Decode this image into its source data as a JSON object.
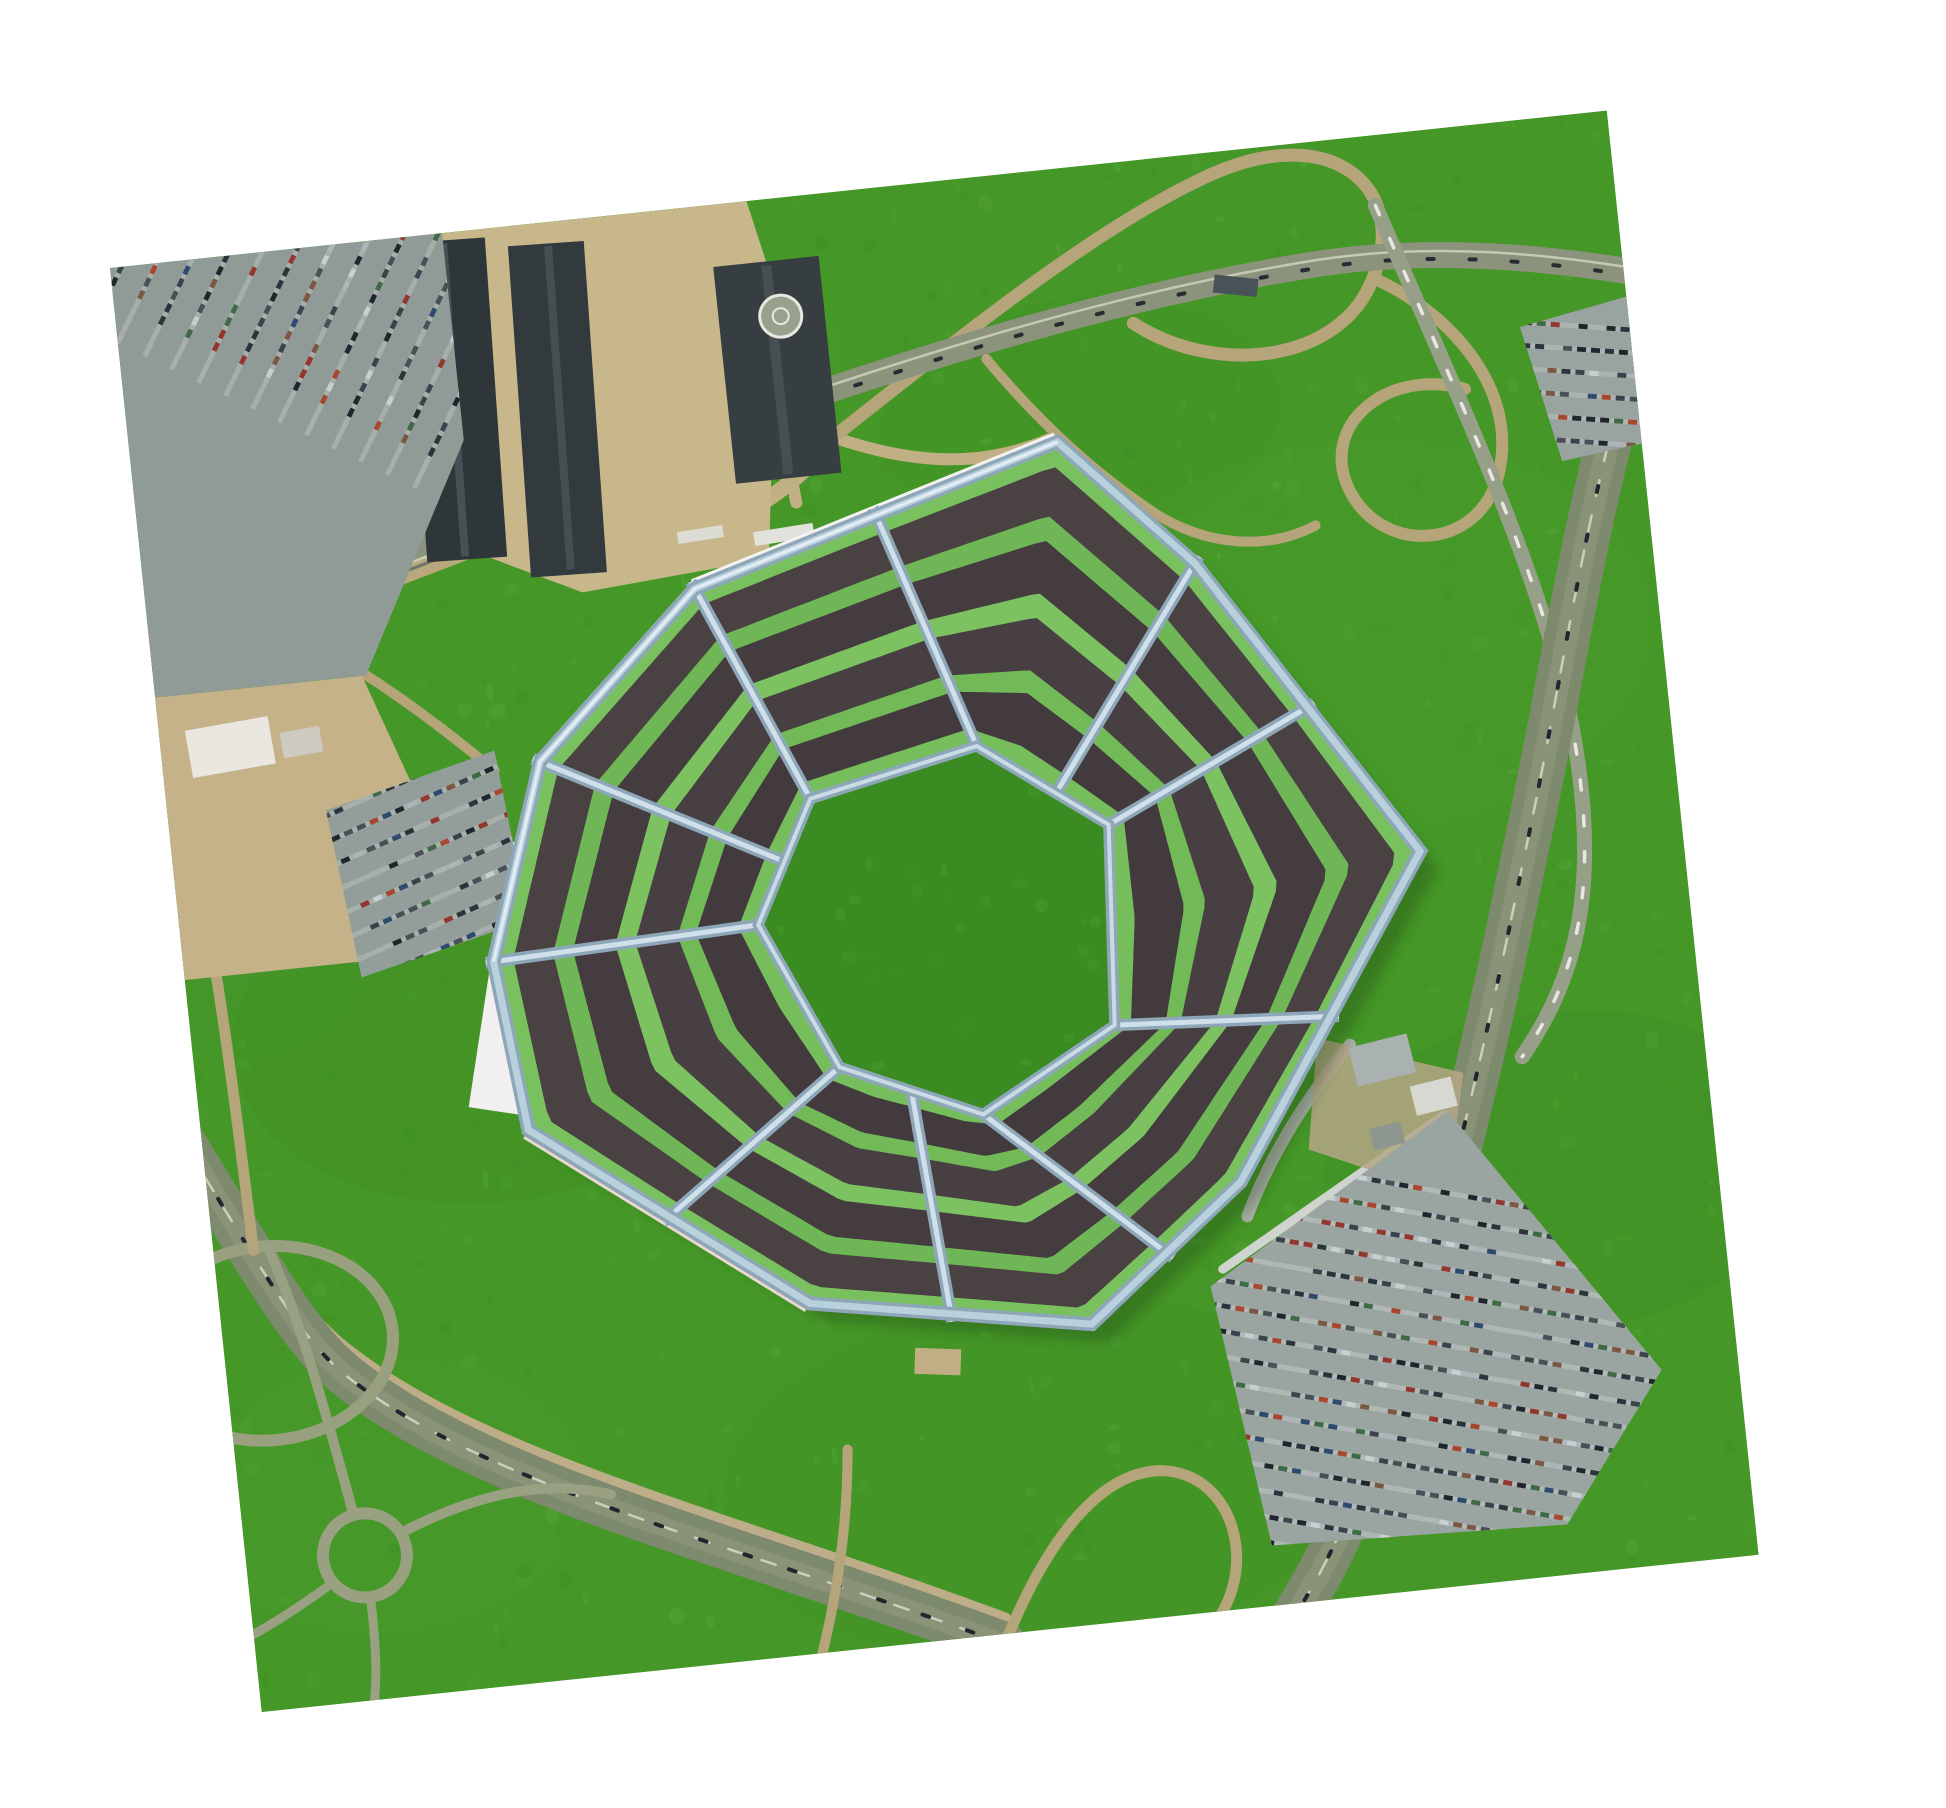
{
  "scene": {
    "description": "aerial-photo-of-heptagon-pentagon-building",
    "canvas": {
      "w": 1946,
      "h": 1808,
      "bg": "#ffffff"
    }
  },
  "photo": {
    "x": 110,
    "y": 268,
    "w": 1505,
    "h": 1452,
    "rotation_deg": -6,
    "base": "#459727"
  },
  "colors": {
    "grass_dark": "#3c8a20",
    "grass_light": "#55ab36",
    "grass_mid": "#498f2b",
    "grass_bright": "#63b545",
    "courtyard": "#3a8c22",
    "stripe_darks": [
      "#4a4143",
      "#443c3f",
      "#473f41",
      "#423a3d"
    ],
    "stripe_greens": [
      "#79c05f",
      "#6fb756",
      "#7cc261",
      "#72b958",
      "#76bd5c"
    ],
    "wall_main": "#8da7b8",
    "wall_light": "#b9d0dd",
    "wall_bright": "#e3eef4",
    "maroon_base": "#6e4038",
    "white_fringe": "#f4f1ef",
    "road_tan": "#b6a47a",
    "road_gray": "#8c937c",
    "highway": "#7d8a6d",
    "parking_gray": "#97a29e"
  },
  "grass": {
    "speckle_count": 650,
    "patches": [
      {
        "cx": 300,
        "cy": 800,
        "rx": 260,
        "ry": 170,
        "fill": "#3c8a20",
        "op": 0.18
      },
      {
        "cx": 1200,
        "cy": 500,
        "rx": 300,
        "ry": 200,
        "fill": "#52a833",
        "op": 0.15
      },
      {
        "cx": 800,
        "cy": 1300,
        "rx": 320,
        "ry": 180,
        "fill": "#3c8a20",
        "op": 0.15
      },
      {
        "cx": 500,
        "cy": 150,
        "rx": 220,
        "ry": 130,
        "fill": "#54ab36",
        "op": 0.12
      },
      {
        "cx": 1350,
        "cy": 1050,
        "rx": 240,
        "ry": 160,
        "fill": "#3b8a21",
        "op": 0.14
      },
      {
        "cx": 150,
        "cy": 1250,
        "rx": 200,
        "ry": 140,
        "fill": "#52a833",
        "op": 0.12
      },
      {
        "cx": 950,
        "cy": 250,
        "rx": 200,
        "ry": 120,
        "fill": "#3c8a20",
        "op": 0.1
      },
      {
        "cx": 60,
        "cy": 600,
        "rx": 160,
        "ry": 200,
        "fill": "#3e9125",
        "op": 0.15
      }
    ]
  },
  "roads": [
    {
      "d": "M -20 392 L 578 232",
      "s": "#b9a87e",
      "w": 54
    },
    {
      "d": "M -20 408 L 578 248",
      "s": "#6f7566",
      "w": 3
    },
    {
      "d": "M -20 386 L 578 226",
      "s": "#8c937c",
      "w": 30
    },
    {
      "d": "M -18 370 L 580 210",
      "s": "#c8cdb8",
      "w": 2.5
    },
    {
      "d": "M -22 402 L 576 242",
      "s": "#c8cdb8",
      "w": 2.5
    },
    {
      "d": "M -20 386 L 578 226",
      "s": "#242a31",
      "w": 4,
      "dash": "7 34"
    },
    {
      "d": "M 470 345 C 560 335 645 305 703 243",
      "s": "#c2b085",
      "w": 16
    },
    {
      "d": "M 622 82 C 642 170 652 230 658 305",
      "s": "#c2b085",
      "w": 12
    },
    {
      "d": "M 700 243 C 770 276 840 292 918 268",
      "s": "#c2b085",
      "w": 12
    },
    {
      "d": "M 703 243 C 850 150 990 60 1105 22 C 1235 -20 1300 60 1255 142 C 1215 222 1090 225 1012 162",
      "s": "#b6a47a",
      "w": 13
    },
    {
      "d": "M 1255 142 C 1325 182 1385 262 1362 342 C 1340 424 1238 422 1210 352 C 1183 282 1262 232 1335 262",
      "s": "#b6a47a",
      "w": 12
    },
    {
      "d": "M 565 228 C 800 172 1005 132 1205 122 C 1325 117 1435 142 1510 162",
      "s": "#8c937c",
      "w": 26
    },
    {
      "d": "M 565 224 C 800 168 1005 128 1205 118 C 1325 113 1435 138 1510 158",
      "s": "#c4c9b4",
      "w": 2.5
    },
    {
      "d": "M 565 232 C 800 176 1005 136 1205 126 C 1325 121 1435 146 1510 166",
      "s": "#262c33",
      "w": 4,
      "dash": "6 36"
    },
    {
      "d": "M 862 182 C 902 242 952 302 1012 352 C 1062 392 1122 402 1172 382",
      "s": "#b6a47a",
      "w": 10
    },
    {
      "d": "M 1265 70 C 1330 280 1402 480 1408 640 C 1414 780 1382 862 1322 932",
      "s": "#96a089",
      "w": 15
    },
    {
      "d": "M 1265 70 C 1330 280 1402 480 1408 640 C 1414 780 1382 862 1322 932",
      "s": "#e8e8e2",
      "w": 3.5,
      "dash": "10 26"
    },
    {
      "d": "M 1510 232 C 1432 422 1402 562 1342 742 C 1292 902 1222 1102 1152 1262 C 1102 1382 1062 1432 1032 1472",
      "s": "#7d8a6d",
      "w": 46
    },
    {
      "d": "M 1510 232 C 1432 422 1402 562 1342 742 C 1292 902 1222 1102 1152 1262 C 1102 1382 1062 1432 1032 1472",
      "s": "#8a9377",
      "w": 22
    },
    {
      "d": "M 1510 232 C 1432 422 1402 562 1342 742 C 1292 902 1222 1102 1152 1262 C 1102 1382 1062 1432 1032 1472",
      "s": "#c9cfbb",
      "w": 2.5,
      "dash": "16 20"
    },
    {
      "d": "M 1510 232 C 1432 422 1402 562 1342 742 C 1292 902 1222 1102 1152 1262 C 1102 1382 1062 1432 1032 1472",
      "s": "#20262d",
      "w": 4,
      "dash": "6 44"
    },
    {
      "d": "M -30 826 C 60 1016 85 1066 130 1106 C 255 1224 485 1305 750 1436",
      "s": "#bdae89",
      "w": 10
    },
    {
      "d": "M -30 852 C 60 1042 82 1092 125 1132 C 252 1252 482 1332 746 1462",
      "s": "#7d8a6d",
      "w": 44
    },
    {
      "d": "M -30 852 C 60 1042 82 1092 125 1132 C 252 1252 482 1332 746 1462",
      "s": "#8a9377",
      "w": 20
    },
    {
      "d": "M -30 852 C 60 1042 82 1092 125 1132 C 252 1252 482 1332 746 1462",
      "s": "#c9cfbb",
      "w": 2.5,
      "dash": "15 20"
    },
    {
      "d": "M -30 852 C 60 1042 82 1092 125 1132 C 252 1252 482 1332 746 1462",
      "s": "#20262d",
      "w": 4,
      "dash": "7 40"
    },
    {
      "d": "M 746 1462 C 800 1360 860 1300 920 1306 C 995 1316 1008 1420 950 1470",
      "s": "#b6a47a",
      "w": 11
    },
    {
      "d": "M 610 1252 C 602 1332 582 1402 562 1457",
      "s": "#b6a47a",
      "w": 10
    },
    {
      "type": "ellipse",
      "cx": 45,
      "cy": 1086,
      "rx": 125,
      "ry": 97,
      "s": "#98a07f",
      "w": 12
    },
    {
      "type": "circle",
      "cx": 119,
      "cy": 1307,
      "r": 42,
      "s": "#9aa183",
      "w": 12
    },
    {
      "d": "M 112 1266 C 95 1160 78 1060 55 992",
      "s": "#9aa183",
      "w": 10
    },
    {
      "d": "M 158 1288 C 230 1260 300 1248 370 1272",
      "s": "#9aa183",
      "w": 10
    },
    {
      "d": "M 120 1349 C 121 1400 118 1432 112 1458",
      "s": "#9aa183",
      "w": 9
    },
    {
      "d": "M 82 1332 C 30 1362 -5 1377 -22 1382",
      "s": "#9aa183",
      "w": 9
    },
    {
      "d": "M 2 434 C 32 600 36 780 40 992",
      "s": "#b6a47a",
      "w": 11
    },
    {
      "d": "M 1152 902 C 1102 952 1062 1002 1032 1062",
      "s": "#a8b0a6",
      "w": 12
    },
    {
      "d": "M 210 430 C 260 470 300 510 330 540",
      "s": "#b6a47a",
      "w": 10
    },
    {
      "d": "M 1002 1112 L 1238 982",
      "s": "#cfd4cf",
      "w": 9
    }
  ],
  "areas": [
    {
      "name": "plaza",
      "pts": [
        [
          268,
          0
        ],
        [
          640,
          0
        ],
        [
          660,
          95
        ],
        [
          625,
          358
        ],
        [
          436,
          372
        ],
        [
          302,
          305
        ]
      ],
      "fill": "#c9b78c",
      "op": 1
    },
    {
      "name": "construction-site",
      "pts": [
        [
          0,
          432
        ],
        [
          208,
          432
        ],
        [
          252,
          562
        ],
        [
          202,
          716
        ],
        [
          0,
          716
        ]
      ],
      "fill": "#c6b289",
      "op": 1
    },
    {
      "name": "south-apron",
      "pts": [
        [
          1120,
          892
        ],
        [
          1262,
          942
        ],
        [
          1232,
          1062
        ],
        [
          1100,
          1002
        ]
      ],
      "fill": "#b5a687",
      "op": 0.85
    },
    {
      "name": "white-left-annex",
      "pts": [
        [
          337,
          612
        ],
        [
          399,
          628
        ],
        [
          331,
          888
        ],
        [
          269,
          872
        ]
      ],
      "fill": "#f2eff0",
      "op": 1
    }
  ],
  "buildings": [
    {
      "x": 296,
      "y": 6,
      "w": 80,
      "h": 320,
      "fill": "#2f3639",
      "rot": 2
    },
    {
      "x": 330,
      "y": 10,
      "w": 8,
      "h": 314,
      "fill": "#465055",
      "rot": 2
    },
    {
      "x": 398,
      "y": 20,
      "w": 76,
      "h": 332,
      "fill": "#323a3d",
      "rot": 2
    },
    {
      "x": 434,
      "y": 24,
      "w": 8,
      "h": 324,
      "fill": "#454e52",
      "rot": 2
    },
    {
      "x": 600,
      "y": 62,
      "w": 106,
      "h": 218,
      "fill": "#363e41",
      "rot": 0
    },
    {
      "x": 648,
      "y": 66,
      "w": 10,
      "h": 210,
      "fill": "#474f53",
      "rot": 0
    },
    {
      "x": 26,
      "y": 468,
      "w": 84,
      "h": 48,
      "fill": "#e9e7e0",
      "rot": -4
    },
    {
      "x": 120,
      "y": 480,
      "w": 40,
      "h": 26,
      "fill": "#cfcabf",
      "rot": -4
    },
    {
      "x": 1150,
      "y": 905,
      "w": 60,
      "h": 40,
      "fill": "#a9b1b1",
      "rot": -8
    },
    {
      "x": 1207,
      "y": 950,
      "w": 42,
      "h": 30,
      "fill": "#d8d8d2",
      "rot": -8
    },
    {
      "x": 1162,
      "y": 988,
      "w": 32,
      "h": 22,
      "fill": "#8d968f",
      "rot": -8
    },
    {
      "x": 1098,
      "y": 122,
      "w": 44,
      "h": 18,
      "fill": "#4a5259",
      "rot": 12
    },
    {
      "x": 612,
      "y": 330,
      "w": 60,
      "h": 14,
      "fill": "#e2e2dc",
      "rot": -3
    },
    {
      "x": 536,
      "y": 322,
      "w": 46,
      "h": 12,
      "fill": "#dddcd4",
      "rot": -3
    },
    {
      "x": 688,
      "y": 1158,
      "w": 46,
      "h": 26,
      "fill": "#c2ae85",
      "rot": 8
    }
  ],
  "helipad": {
    "cx": 662,
    "cy": 118,
    "r": 21,
    "fill": "#98a18c",
    "ring": "#e9e7e2"
  },
  "parking_lots": [
    {
      "name": "northwest-lot",
      "poly": [
        [
          0,
          0
        ],
        [
          334,
          0
        ],
        [
          334,
          208
        ],
        [
          212,
          432
        ],
        [
          0,
          432
        ]
      ],
      "fill": "#909b97",
      "rows": {
        "angle": -58,
        "spacing": 30,
        "count": 20,
        "origin": [
          -30,
          10
        ],
        "len": 430,
        "aisle": "#b9c0bb"
      }
    },
    {
      "name": "west-lot",
      "poly": [
        [
          158,
          562
        ],
        [
          332,
          520
        ],
        [
          348,
          692
        ],
        [
          176,
          732
        ]
      ],
      "fill": "#939e9a",
      "rows": {
        "angle": -18,
        "spacing": 24,
        "count": 9,
        "origin": [
          150,
          545
        ],
        "len": 230,
        "aisle": "#b9c0bb"
      }
    },
    {
      "name": "northeast-lot",
      "poly": [
        [
          1396,
          206
        ],
        [
          1510,
          186
        ],
        [
          1510,
          334
        ],
        [
          1424,
          344
        ]
      ],
      "fill": "#99a3a0",
      "rows": {
        "angle": 10,
        "spacing": 23,
        "count": 7,
        "origin": [
          1390,
          200
        ],
        "len": 140,
        "aisle": "#bcc3bf"
      }
    },
    {
      "name": "south-lot",
      "poly": [
        [
          988,
          1128
        ],
        [
          1242,
          978
        ],
        [
          1428,
          1258
        ],
        [
          1318,
          1402
        ],
        [
          1022,
          1392
        ]
      ],
      "fill": "#9aa5a2",
      "rows": {
        "angle": 16,
        "spacing": 25,
        "count": 17,
        "origin": [
          962,
          982
        ],
        "len": 560,
        "aisle": "#c2c9c4"
      }
    }
  ],
  "car_palette": {
    "dark": [
      "#1f262e",
      "#2b333c",
      "#3a424b",
      "#494f57"
    ],
    "light": [
      "#c9ced3",
      "#aeb4b9"
    ],
    "cool": [
      "#2e4a6e",
      "#3f6a46"
    ],
    "warm": [
      "#7c5844",
      "#93372e",
      "#a8472f"
    ]
  },
  "building": {
    "outer": [
      [
        924,
        272
      ],
      [
        1048,
        407
      ],
      [
        1242,
        717
      ],
      [
        1029,
        1027
      ],
      [
        866,
        1153
      ],
      [
        588,
        1103
      ],
      [
        326,
        901
      ],
      [
        309,
        730
      ],
      [
        376,
        536
      ],
      [
        548,
        380
      ]
    ],
    "inner": [
      [
        812,
        566
      ],
      [
        935,
        658
      ],
      [
        920,
        858
      ],
      [
        780,
        933
      ],
      [
        642,
        871
      ],
      [
        576,
        721
      ],
      [
        641,
        601
      ]
    ],
    "stripe_stops": [
      0,
      0.075,
      0.225,
      0.3,
      0.46,
      0.535,
      0.695,
      0.765,
      0.925,
      1
    ],
    "sections": [
      {
        "outer": [
          [
            548,
            380
          ],
          [
            736,
            326
          ]
        ],
        "inner": [
          [
            641,
            601
          ],
          [
            812,
            566
          ]
        ]
      },
      {
        "outer": [
          [
            736,
            326
          ],
          [
            924,
            272
          ],
          [
            1048,
            407
          ]
        ],
        "inner": [
          [
            812,
            566
          ],
          [
            886,
            621
          ]
        ]
      },
      {
        "outer": [
          [
            1048,
            407
          ],
          [
            1145,
            562
          ]
        ],
        "inner": [
          [
            886,
            621
          ],
          [
            935,
            658
          ]
        ]
      },
      {
        "outer": [
          [
            1145,
            562
          ],
          [
            1242,
            717
          ],
          [
            1136,
            872
          ]
        ],
        "inner": [
          [
            935,
            658
          ],
          [
            920,
            858
          ]
        ]
      },
      {
        "outer": [
          [
            1136,
            872
          ],
          [
            1029,
            1027
          ],
          [
            948,
            1090
          ]
        ],
        "inner": [
          [
            920,
            858
          ],
          [
            780,
            933
          ]
        ]
      },
      {
        "outer": [
          [
            948,
            1090
          ],
          [
            866,
            1153
          ],
          [
            727,
            1128
          ]
        ],
        "inner": [
          [
            780,
            933
          ],
          [
            711,
            902
          ]
        ]
      },
      {
        "outer": [
          [
            727,
            1128
          ],
          [
            588,
            1103
          ],
          [
            457,
            1002
          ]
        ],
        "inner": [
          [
            711,
            902
          ],
          [
            642,
            871
          ]
        ]
      },
      {
        "outer": [
          [
            457,
            1002
          ],
          [
            326,
            901
          ],
          [
            309,
            730
          ]
        ],
        "inner": [
          [
            642,
            871
          ],
          [
            576,
            721
          ]
        ]
      },
      {
        "outer": [
          [
            309,
            730
          ],
          [
            376,
            536
          ]
        ],
        "inner": [
          [
            576,
            721
          ],
          [
            609,
            661
          ]
        ]
      },
      {
        "outer": [
          [
            376,
            536
          ],
          [
            548,
            380
          ]
        ],
        "inner": [
          [
            609,
            661
          ],
          [
            641,
            601
          ]
        ]
      }
    ],
    "walls": [
      [
        [
          548,
          380
        ],
        [
          641,
          601
        ]
      ],
      [
        [
          736,
          326
        ],
        [
          812,
          566
        ]
      ],
      [
        [
          1048,
          407
        ],
        [
          886,
          621
        ]
      ],
      [
        [
          1145,
          562
        ],
        [
          935,
          658
        ]
      ],
      [
        [
          1136,
          872
        ],
        [
          920,
          858
        ]
      ],
      [
        [
          948,
          1090
        ],
        [
          780,
          933
        ]
      ],
      [
        [
          727,
          1128
        ],
        [
          711,
          902
        ]
      ],
      [
        [
          457,
          1002
        ],
        [
          642,
          871
        ]
      ],
      [
        [
          309,
          730
        ],
        [
          576,
          721
        ]
      ],
      [
        [
          376,
          536
        ],
        [
          609,
          661
        ]
      ]
    ],
    "edge_strokes": [
      {
        "pts": [
          [
            588,
            1103
          ],
          [
            326,
            901
          ]
        ],
        "stroke": "#e9d9d3",
        "w": 20
      },
      {
        "pts": [
          [
            1029,
            1027
          ],
          [
            866,
            1153
          ],
          [
            588,
            1103
          ],
          [
            326,
            901
          ]
        ],
        "stroke": "#6e4038",
        "w": 14
      },
      {
        "pts": [
          [
            548,
            380
          ],
          [
            924,
            272
          ]
        ],
        "stroke": "#f4f1ef",
        "w": 20
      },
      {
        "pts": [
          [
            376,
            536
          ],
          [
            548,
            380
          ]
        ],
        "stroke": "#f4f1ef",
        "w": 14
      }
    ],
    "bright_edge": [
      [
        309,
        730
      ],
      [
        376,
        536
      ],
      [
        548,
        380
      ],
      [
        924,
        272
      ]
    ],
    "shadow": {
      "dx": 16,
      "dy": 20,
      "fill": "#16320d",
      "op": 0.28
    }
  }
}
